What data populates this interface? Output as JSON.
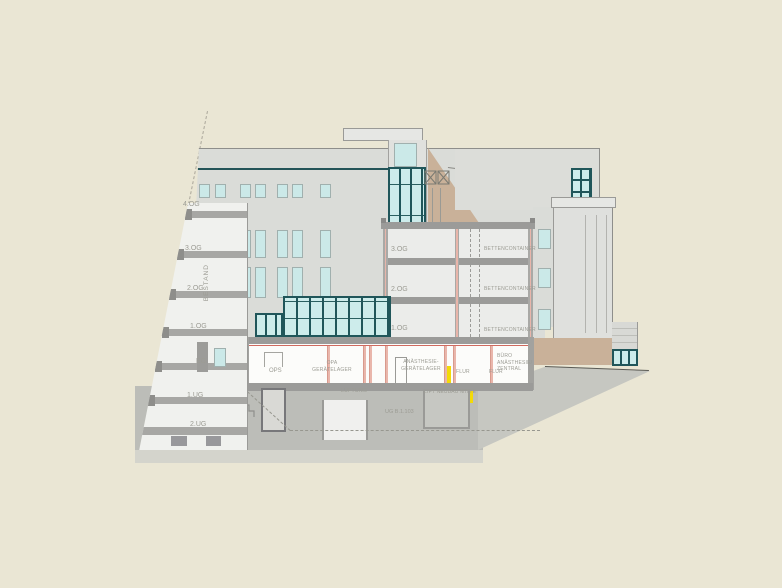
{
  "drawing": {
    "kind": "building-section-elevation",
    "labels": {
      "bestand": "BESTAND",
      "left_floors": [
        "4.OG",
        "3.OG",
        "2.OG",
        "1.OG",
        "EG",
        "1.UG",
        "2.UG"
      ],
      "section_levels": [
        "3.OG",
        "2.OG",
        "1.OG"
      ],
      "bed_rooms": [
        "BETTENCONTAINER",
        "BETTENCONTAINER",
        "BETTENCONTAINER"
      ],
      "eg": {
        "ops": "OPS",
        "opa": [
          "OPA",
          "GERÄTELAGER"
        ],
        "anaesthesie": [
          "ANÄSTHESIE-",
          "GERÄTELAGER"
        ],
        "flur_left": "FLUR",
        "flur_right": "FLUR",
        "buero": [
          "BÜRO",
          "ANÄSTHESIE/",
          "ZENTRAL"
        ]
      },
      "ug": {
        "lueftung": "LÜFTUNG",
        "lift": "LIFT NEUBAU MITTE",
        "room": "UG B.1.103"
      }
    },
    "colors": {
      "background": "#eae6d4",
      "building_grey": "#dadcd8",
      "slab_grey": "#9b9b99",
      "ground_grey": "#bcbdb8",
      "ground_light": "#d4d4cc",
      "glass_blue": "#cbe9e8",
      "frame_teal": "#20565a",
      "tan_ramp": "#c9b199",
      "cut_wall_pink": "#e9b6ab",
      "marker_yellow": "#f3da08",
      "accent_red": "#c0392b",
      "label_grey": "#9c9c94"
    }
  }
}
